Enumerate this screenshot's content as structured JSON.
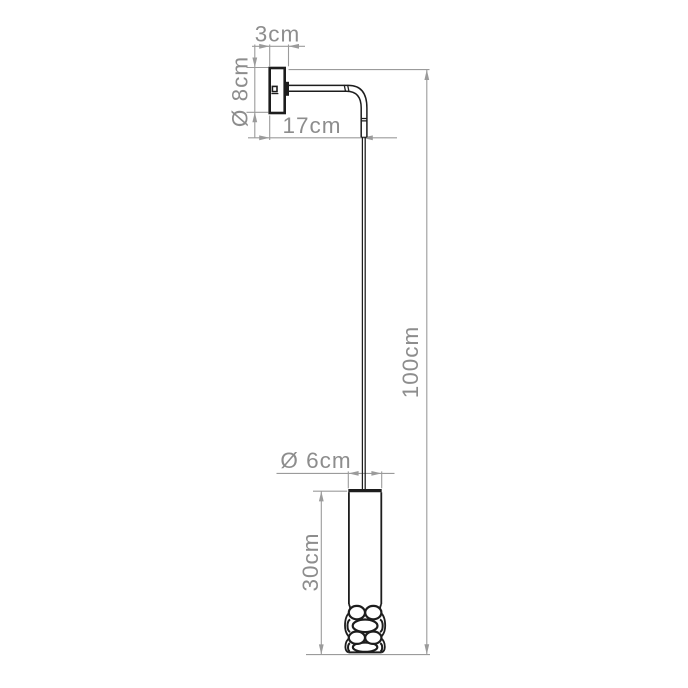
{
  "figure": {
    "type": "technical-dimension-drawing",
    "subject": "wall-mounted drop pendant lamp, side elevation"
  },
  "colors": {
    "fixture": "#1d1d1d",
    "dimension": "#9b9b9b",
    "label": "#8d8d8d",
    "background": "#ffffff"
  },
  "dimensions": {
    "bracket_depth": {
      "label": "3cm",
      "value_cm": 3,
      "orientation": "horizontal",
      "measures": "wall bracket depth"
    },
    "plate_diameter": {
      "label": "Ø 8cm",
      "value_cm": 8,
      "orientation": "vertical",
      "measures": "wall plate diameter"
    },
    "arm_projection": {
      "label": "17cm",
      "value_cm": 17,
      "orientation": "horizontal",
      "measures": "arm projection from wall"
    },
    "overall_drop": {
      "label": "100cm",
      "value_cm": 100,
      "orientation": "vertical",
      "measures": "overall drop height"
    },
    "shade_diameter": {
      "label": "Ø 6cm",
      "value_cm": 6,
      "orientation": "horizontal",
      "measures": "shade diameter"
    },
    "shade_height": {
      "label": "30cm",
      "value_cm": 30,
      "orientation": "vertical",
      "measures": "shade height"
    }
  }
}
